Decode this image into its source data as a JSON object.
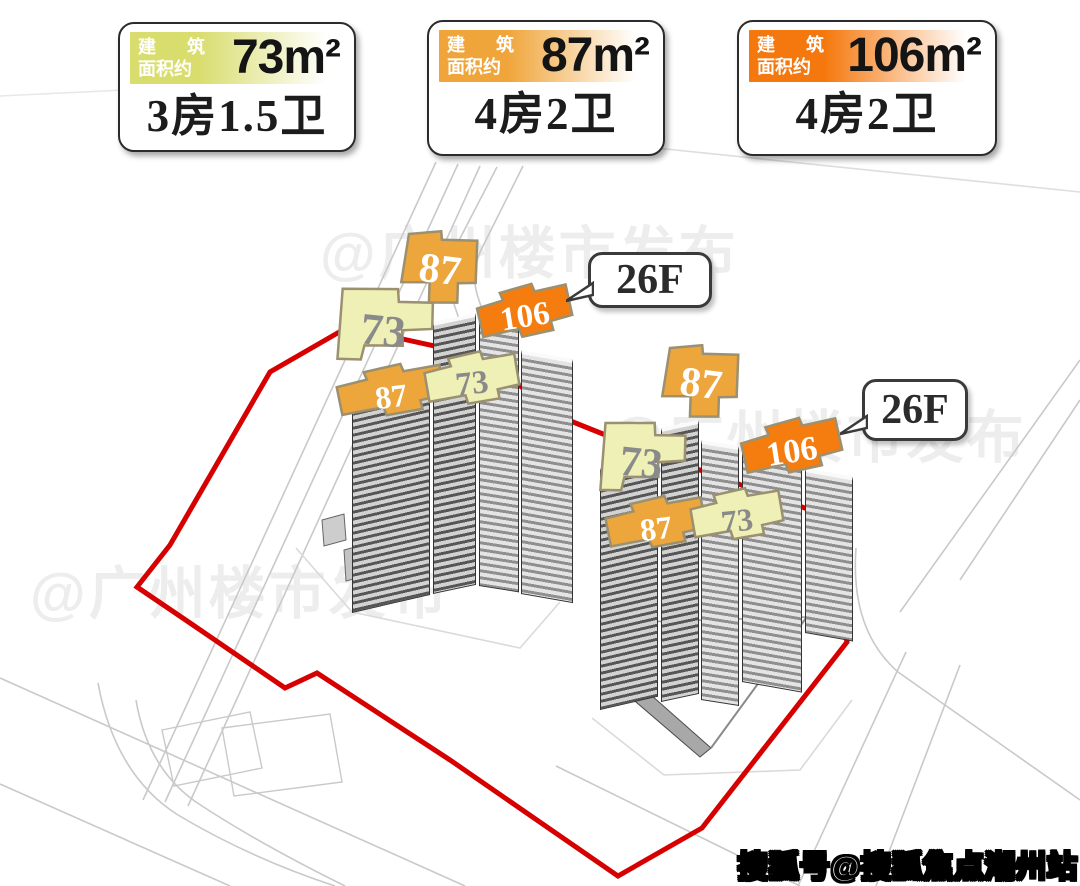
{
  "unit_cards": [
    {
      "area_prefix_line1": "建 筑",
      "area_prefix_line2": "面积约",
      "area_value": "73m²",
      "unit_type": "3房1.5卫",
      "band_color": "#d9dd6e"
    },
    {
      "area_prefix_line1": "建 筑",
      "area_prefix_line2": "面积约",
      "area_value": "87m²",
      "unit_type": "4房2卫",
      "band_color": "#f0a53a"
    },
    {
      "area_prefix_line1": "建 筑",
      "area_prefix_line2": "面积约",
      "area_value": "106m²",
      "unit_type": "4房2卫",
      "band_color": "#f5780e"
    }
  ],
  "floor_count_bubbles": [
    {
      "label": "26F"
    },
    {
      "label": "26F"
    }
  ],
  "floor_area_labels": [
    {
      "text": "87",
      "variant": "A",
      "x": 396,
      "y": 228,
      "w": 88,
      "h": 84,
      "rot": 7,
      "fill": "#eda63b",
      "text_color": "#ffffff"
    },
    {
      "text": "73",
      "variant": "B",
      "x": 330,
      "y": 286,
      "w": 106,
      "h": 90,
      "rot": 6,
      "fill": "#eef0b5",
      "text_color": "#8a8a8a"
    },
    {
      "text": "106",
      "variant": "C",
      "x": 477,
      "y": 284,
      "w": 96,
      "h": 66,
      "rot": -9,
      "fill": "#f57d10",
      "text_color": "#ffffff"
    },
    {
      "text": "87",
      "variant": "C",
      "x": 336,
      "y": 364,
      "w": 110,
      "h": 64,
      "rot": -7,
      "fill": "#eda63b",
      "text_color": "#ffffff"
    },
    {
      "text": "73",
      "variant": "C",
      "x": 424,
      "y": 351,
      "w": 96,
      "h": 66,
      "rot": -6,
      "fill": "#eef0b5",
      "text_color": "#8a8a8a"
    },
    {
      "text": "87",
      "variant": "A",
      "x": 657,
      "y": 342,
      "w": 88,
      "h": 84,
      "rot": 7,
      "fill": "#eda63b",
      "text_color": "#ffffff"
    },
    {
      "text": "73",
      "variant": "B",
      "x": 594,
      "y": 420,
      "w": 94,
      "h": 86,
      "rot": 6,
      "fill": "#eef0b5",
      "text_color": "#8a8a8a"
    },
    {
      "text": "106",
      "variant": "C",
      "x": 741,
      "y": 418,
      "w": 102,
      "h": 68,
      "rot": -9,
      "fill": "#f57d10",
      "text_color": "#ffffff"
    },
    {
      "text": "87",
      "variant": "C",
      "x": 605,
      "y": 496,
      "w": 102,
      "h": 64,
      "rot": -7,
      "fill": "#eda63b",
      "text_color": "#ffffff"
    },
    {
      "text": "73",
      "variant": "C",
      "x": 690,
      "y": 488,
      "w": 94,
      "h": 64,
      "rot": -6,
      "fill": "#eef0b5",
      "text_color": "#8a8a8a"
    }
  ],
  "watermarks": {
    "publisher": "@广州楼市发布",
    "sohu_badge": "搜狐号@搜狐焦点潮州站"
  },
  "site": {
    "boundary_color": "#d60000",
    "road_color": "#c9c9c9"
  }
}
